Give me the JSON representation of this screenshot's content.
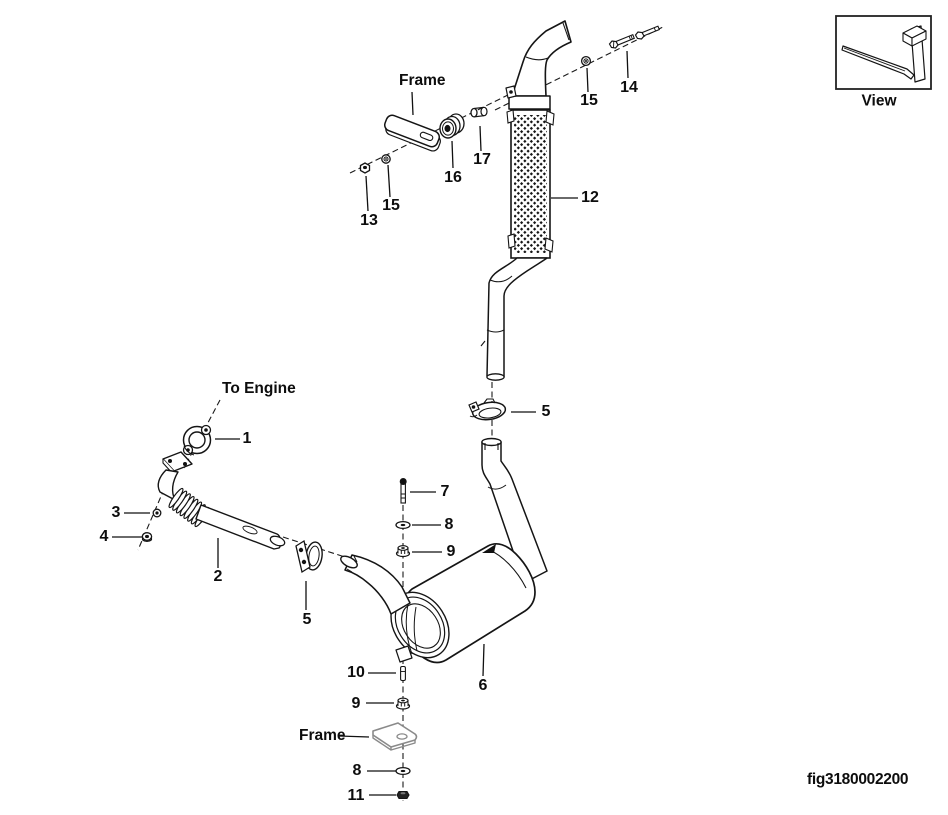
{
  "figure": {
    "id": "fig3180002200"
  },
  "view_indicator": {
    "label": "View"
  },
  "annotations": {
    "to_engine": "To Engine",
    "frame_upper": "Frame",
    "frame_lower": "Frame"
  },
  "callouts": {
    "c1": "1",
    "c2": "2",
    "c3": "3",
    "c4": "4",
    "c5_upper": "5",
    "c5_lower": "5",
    "c6": "6",
    "c7": "7",
    "c8_mid": "8",
    "c8_bottom": "8",
    "c9_mid": "9",
    "c9_bottom": "9",
    "c10": "10",
    "c11": "11",
    "c12": "12",
    "c13": "13",
    "c14": "14",
    "c15_top": "15",
    "c15_frame": "15",
    "c16": "16",
    "c17": "17"
  }
}
